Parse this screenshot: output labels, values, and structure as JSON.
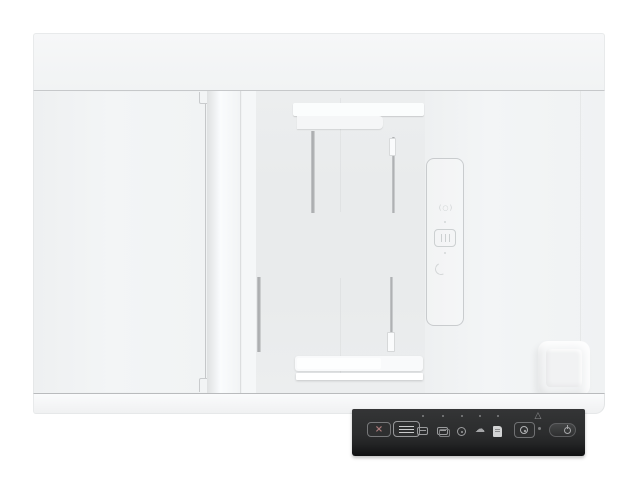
{
  "meta": {
    "title": "Flatbed scanner with automatic document feeder, top-down product photo",
    "background_color": "#ffffff"
  },
  "device": {
    "body_color": "#f1f3f4",
    "tray_color": "#fbfdfd",
    "adf_bed_color": "#e9ebec",
    "seam_color": "#c6c8ca",
    "parts": {
      "rear_cover": "rear cover band",
      "flatbed_lid": "flatbed lid",
      "adf_input_tray": "ADF input tray with sliding paper guides",
      "adf_output_tray": "ADF output tray with sliding paper guides",
      "corner_pad": "lid corner pad"
    },
    "embossed_icons": [
      {
        "name": "media-mark-icon",
        "glyph": "(○)"
      },
      {
        "name": "paper-stack-icon",
        "glyph": ""
      },
      {
        "name": "curl-arrow-icon",
        "glyph": ""
      }
    ]
  },
  "control_panel": {
    "panel_color": "#2b2c2d",
    "button_face_color": "#2e2f30",
    "button_border_color": "#77787a",
    "icon_color": "#9b9c9e",
    "shortcut_led_count": 5,
    "cancel": {
      "glyph": "×"
    },
    "cloud": {
      "glyph": "☁"
    },
    "warning": {
      "glyph": "△"
    },
    "buttons": [
      {
        "name": "cancel-button"
      },
      {
        "name": "lcd-display"
      },
      {
        "name": "simplex-scan-icon"
      },
      {
        "name": "duplex-scan-icon"
      },
      {
        "name": "gear-icon"
      },
      {
        "name": "cloud-icon"
      },
      {
        "name": "document-icon"
      },
      {
        "name": "scan-button"
      },
      {
        "name": "power-button"
      }
    ]
  }
}
